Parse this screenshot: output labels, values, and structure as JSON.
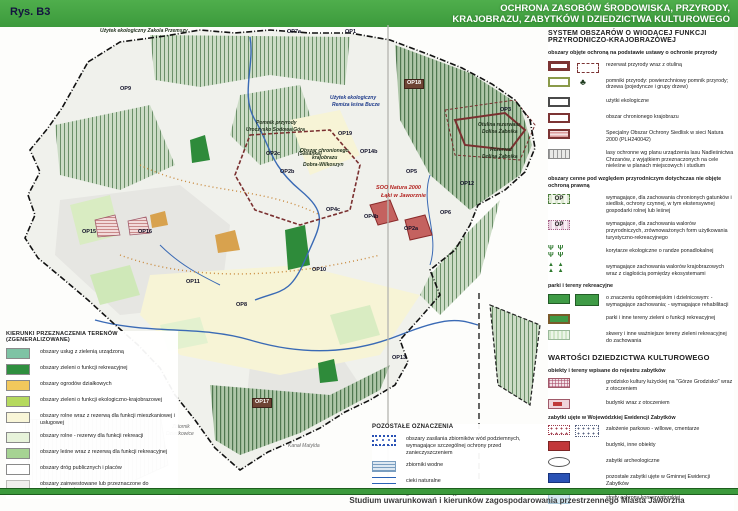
{
  "header": {
    "figure_label": "Rys. B3",
    "title_line1": "OCHRONA ZASOBÓW ŚRODOWISKA, PRZYRODY,",
    "title_line2": "KRAJOBRAZU, ZABYTKÓW I DZIEDZICTWA KULTUROWEGO"
  },
  "footer": {
    "caption": "Studium uwarunkowań i kierunków zagospodarowania przestrzennego Miasta Jaworzna"
  },
  "colors": {
    "header_green": "#3c9a3c",
    "boundary_black": "#111111",
    "reserve_maroon": "#7a3030",
    "natura_red": "#c4625f",
    "river_blue": "#3a6ab5",
    "forest_green": "#6a8f68",
    "cream_fields": "#f7f4d6"
  },
  "map": {
    "labels": [
      {
        "text": "Użytek ekologiczny Zakola Przemszy",
        "x": 100,
        "y": 29,
        "cls": "feat"
      },
      {
        "text": "OP7a",
        "x": 287,
        "y": 30
      },
      {
        "text": "OP1",
        "x": 345,
        "y": 30
      },
      {
        "text": "OP9",
        "x": 120,
        "y": 87
      },
      {
        "text": "OP18",
        "x": 404,
        "y": 79,
        "cls": "boxed"
      },
      {
        "text": "Użytek ekologiczny",
        "x": 330,
        "y": 96,
        "cls": "feat-blue"
      },
      {
        "text": "Remiza leśna Bucze",
        "x": 332,
        "y": 103,
        "cls": "feat-blue"
      },
      {
        "text": "OP3",
        "x": 500,
        "y": 108
      },
      {
        "text": "Pomnik przyrody",
        "x": 256,
        "y": 121,
        "cls": "feat"
      },
      {
        "text": "Uroczysko Sodowa Góra",
        "x": 246,
        "y": 128,
        "cls": "feat"
      },
      {
        "text": "OP2c",
        "x": 266,
        "y": 152
      },
      {
        "text": "(Sasanka)",
        "x": 298,
        "y": 152,
        "cls": "feat"
      },
      {
        "text": "OP19",
        "x": 338,
        "y": 132
      },
      {
        "text": "Otulina rezerwatu",
        "x": 478,
        "y": 123,
        "cls": "feat"
      },
      {
        "text": "Dolina Żabnika",
        "x": 482,
        "y": 130,
        "cls": "feat"
      },
      {
        "text": "Rezerwat",
        "x": 490,
        "y": 148,
        "cls": "feat"
      },
      {
        "text": "Dolina Żabnika",
        "x": 482,
        "y": 155,
        "cls": "feat"
      },
      {
        "text": "Obszar chronionego",
        "x": 300,
        "y": 149,
        "cls": "feat"
      },
      {
        "text": "krajobrazu",
        "x": 312,
        "y": 156,
        "cls": "feat"
      },
      {
        "text": "Dobra-Wilkoszyn",
        "x": 303,
        "y": 163,
        "cls": "feat"
      },
      {
        "text": "OP14b",
        "x": 360,
        "y": 150
      },
      {
        "text": "OP2b",
        "x": 280,
        "y": 170
      },
      {
        "text": "OP5",
        "x": 406,
        "y": 170
      },
      {
        "text": "SOO Natura 2000",
        "x": 376,
        "y": 186,
        "cls": "feat-red"
      },
      {
        "text": "Łąki w Jaworznie",
        "x": 381,
        "y": 194,
        "cls": "feat-red"
      },
      {
        "text": "OP12",
        "x": 460,
        "y": 182
      },
      {
        "text": "OP6",
        "x": 440,
        "y": 211
      },
      {
        "text": "OP4c",
        "x": 326,
        "y": 208
      },
      {
        "text": "OP4b",
        "x": 364,
        "y": 215
      },
      {
        "text": "OP2a",
        "x": 404,
        "y": 227
      },
      {
        "text": "OP15",
        "x": 82,
        "y": 230
      },
      {
        "text": "OP16",
        "x": 138,
        "y": 230
      },
      {
        "text": "OP11",
        "x": 186,
        "y": 280
      },
      {
        "text": "OP10",
        "x": 312,
        "y": 268
      },
      {
        "text": "OP8",
        "x": 236,
        "y": 303
      },
      {
        "text": "OP13",
        "x": 392,
        "y": 356
      },
      {
        "text": "OP17",
        "x": 252,
        "y": 398,
        "cls": "boxed"
      },
      {
        "text": "Zbiornik",
        "x": 172,
        "y": 425,
        "cls": "feat-gray"
      },
      {
        "text": "Dziećkowice",
        "x": 166,
        "y": 432,
        "cls": "feat-gray"
      },
      {
        "text": "Kanał Matylda",
        "x": 288,
        "y": 444,
        "cls": "feat-gray"
      }
    ]
  },
  "legend_left": {
    "title": "KIERUNKI PRZEZNACZENIA TERENÓW (ZGENERALIZOWANE)",
    "items": [
      {
        "type": "teal",
        "label": "obszary usług z zielenią urządzoną"
      },
      {
        "type": "green-dark",
        "label": "obszary zieleni o funkcji rekreacyjnej"
      },
      {
        "type": "yellow",
        "label": "obszary ogrodów działkowych"
      },
      {
        "type": "yellow-green",
        "label": "obszary zieleni o funkcji ekologiczno-krajobrazowej"
      },
      {
        "type": "cream",
        "label": "obszary rolne wraz z rezerwą dla funkcji mieszkaniowej i usługowej"
      },
      {
        "type": "pale-green",
        "label": "obszary rolne - rezerwy dla funkcji rekreacji"
      },
      {
        "type": "mid-green",
        "label": "obszary leśne wraz z rezerwą dla funkcji rekreacyjnej"
      },
      {
        "type": "white",
        "label": "obszary dróg publicznych i placów"
      },
      {
        "type": "grayinv",
        "label": "obszary zainwestowane lub przeznaczone do zainwestowania"
      }
    ]
  },
  "legend_other": {
    "title": "POZOSTAŁE OZNACZENIA",
    "items": [
      {
        "type": "aquifer",
        "label": "obszary zasilania zbiorników wód podziemnych, wymagające szczególnej ochrony przed zanieczyszczeniem"
      },
      {
        "type": "zbiornik",
        "label": "zbiorniki wodne"
      },
      {
        "type": "cieki",
        "label": "cieki naturalne"
      },
      {
        "type": "granica",
        "label": "granica administracyjna miasta Jaworzna"
      }
    ]
  },
  "panel_right": {
    "system_title": "SYSTEM OBSZARÓW O WIODĄCEJ FUNKCJI PRZYRODNICZO-KRAJOBRAZOWEJ",
    "entries": [
      {
        "kind": "sub",
        "label": "obszary objęte ochroną na podstawie ustawy o ochronie przyrody"
      },
      {
        "type": "reserve",
        "label": "rezerwat przyrody wraz z otuliną"
      },
      {
        "type": "pomnik",
        "label": "pomniki przyrody: powierzchniowy pomnik przyrody; drzewa (pojedyncze i grupy drzew)"
      },
      {
        "type": "uzytki",
        "label": "użytki ekologiczne"
      },
      {
        "type": "ochk",
        "label": "obszar chronionego krajobrazu"
      },
      {
        "type": "natura",
        "label": "Specjalny Obszar Ochrony Siedlisk w sieci Natura 2000  (PLH240042)"
      },
      {
        "type": "lasy",
        "label": "lasy ochronne wg planu urządzenia lasu Nadleśnictwa Chrzanów, z wyjątkiem przeznaczonych na cele nieleśne w planach miejscowych i studium"
      },
      {
        "kind": "sub",
        "label": "obszary cenne pod względem przyrodniczym dotychczas nie objęte ochroną prawną"
      },
      {
        "type": "op-green",
        "swatch_text": "OP",
        "label": "wymagające, dla zachowania chronionych gatunków i siedlisk, ochrony czynnej, w tym ekstensywnej gospodarki rolnej lub leśnej"
      },
      {
        "type": "op-pink",
        "swatch_text": "OP",
        "label": "wymagające, dla zachowania walorów przyrodniczych, zrównoważonych form użytkowania turystyczno-rekreacyjnego"
      },
      {
        "type": "glyphs",
        "swatch_text": "Ψ Ψ Ψ Ψ",
        "label": "korytarze ekologiczne o randze ponadlokalnej"
      },
      {
        "type": "triangles",
        "swatch_text": "▲ ▲ ▲ ▲",
        "label": "wymagające zachowania walorów krajobrazowych wraz z ciągłością pomiędzy ekosystemami"
      },
      {
        "kind": "sub",
        "label": "parki i tereny rekreacyjne"
      },
      {
        "type": "park-dual",
        "label": "o znaczeniu ogólnomiejskim i dzielnicowym: - wymagające zachowania; - wymagające rehabilitacji"
      },
      {
        "type": "park",
        "label": "parki i inne tereny zieleni o funkcji rekreacyjnej"
      },
      {
        "type": "skwer",
        "label": "skwery i inne ważniejsze tereny zieleni rekreacyjnej do zachowania"
      }
    ],
    "heritage_title": "WARTOŚCI DZIEDZICTWA KULTUROWEGO",
    "heritage_entries": [
      {
        "kind": "sub",
        "label": "obiekty i tereny wpisane do rejestru zabytków"
      },
      {
        "type": "grodzisko",
        "label": "grodzisko kultury łużyckiej na \"Górze Grodzisko\" wraz z otoczeniem"
      },
      {
        "type": "budynki-oto",
        "label": "budynki wraz z otoczeniem"
      },
      {
        "kind": "sub",
        "label": "zabytki ujęte w Wojewódzkiej Ewidencji Zabytków"
      },
      {
        "type": "parkowo",
        "label": "założenie parkowo - willowe, cmentarze"
      },
      {
        "type": "budynek-red",
        "label": "budynki, inne obiekty"
      },
      {
        "type": "arch",
        "label": "zabytki archeologiczne"
      },
      {
        "type": "gez",
        "label": "pozostałe zabytki ujęte w Gminnej Ewidencji Zabytków"
      },
      {
        "type": "strefa",
        "label": "strefy ochrony konserwatorskiej"
      }
    ]
  }
}
